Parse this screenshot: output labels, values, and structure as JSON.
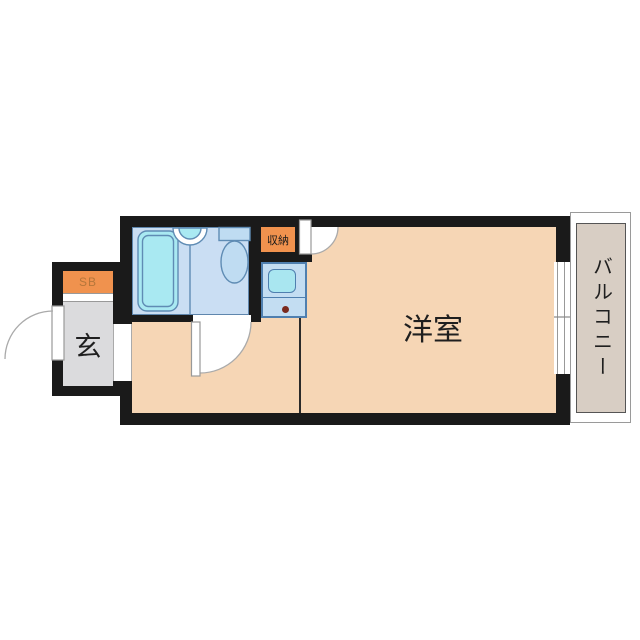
{
  "labels": {
    "main_room": "洋室",
    "balcony": "バルコニー",
    "entrance": "玄",
    "shoe_box": "SB",
    "storage": "収納"
  },
  "icons": {
    "bathtub": "rounded-rectangle-tub-with-rim",
    "washbasin": "half-circle-basin-on-wall",
    "toilet": "tank-rectangle-with-oval-bowl",
    "kitchen_unit": "counter-with-sink-and-burner-dot",
    "door_swing": "quarter-circle-arc-with-leaf",
    "window": "sliding-window-gap-in-wall"
  },
  "colors": {
    "wall": "#1a1a1a",
    "room_floor": "#f6d6b5",
    "bathroom_floor": "#cadef3",
    "bathtub": "#a9e9f2",
    "fixture": "#bfdcf2",
    "fixture_border": "#5f8cb4",
    "kitchen": "#c3ddf2",
    "kitchen_border": "#4f7faf",
    "kitchen_sink": "#a9e6f0",
    "accent_orange": "#f0924e",
    "sb_text": "#b5763a",
    "entrance_floor": "#dbdbdd",
    "balcony_floor": "#d8cec4",
    "door_arc": "#aaaaaa",
    "label_text": "#1f1f1f"
  }
}
